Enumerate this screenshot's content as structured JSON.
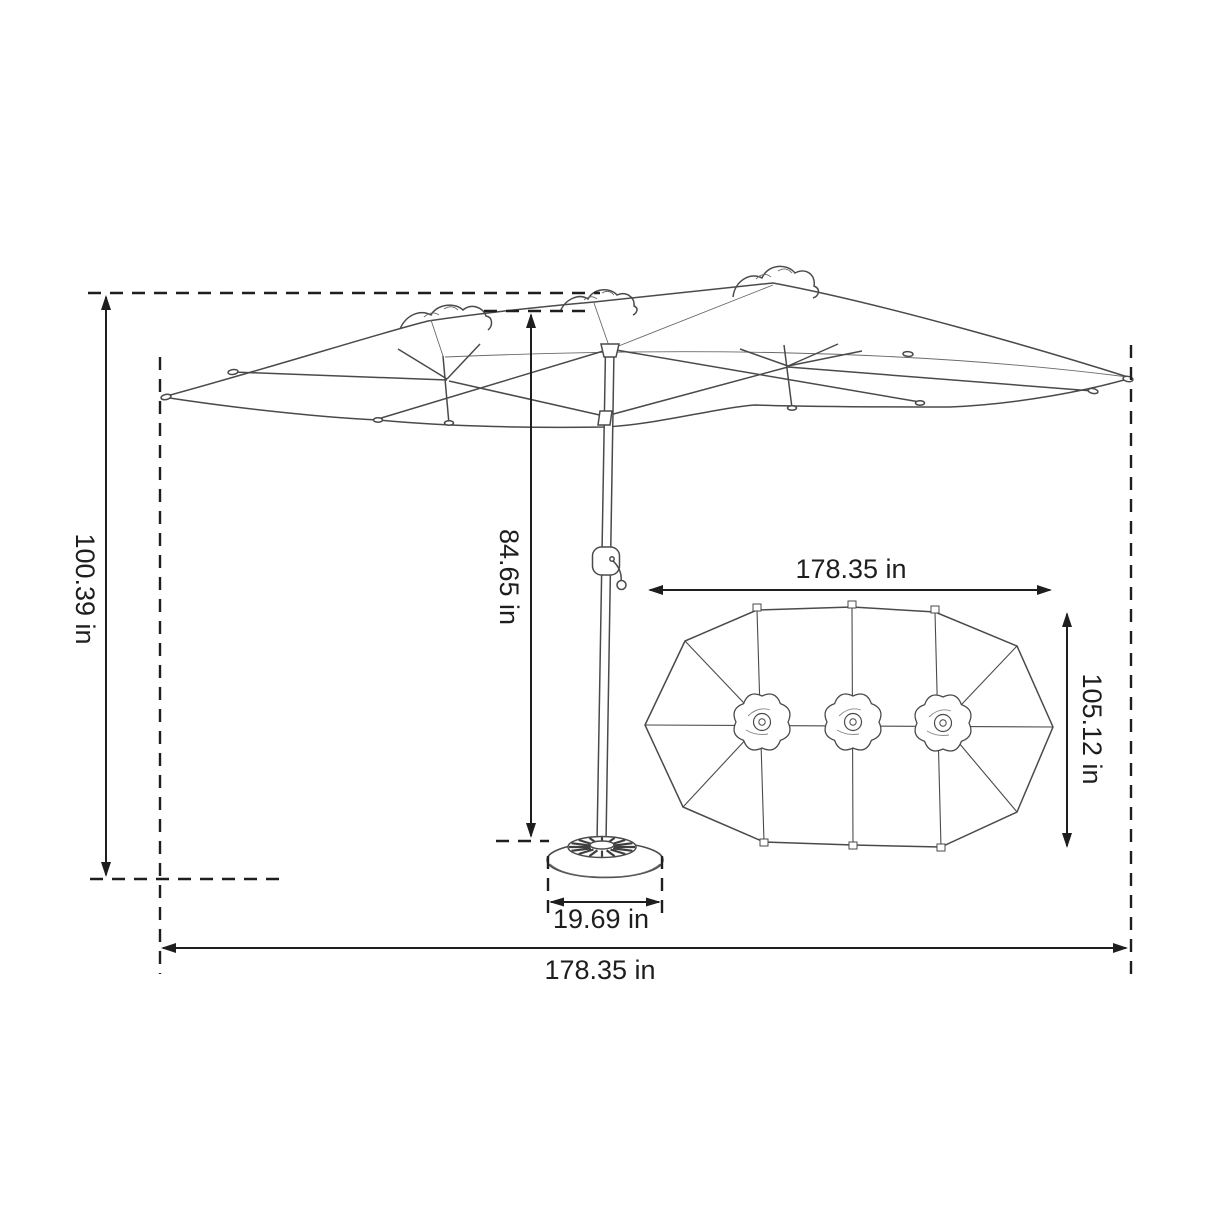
{
  "diagram": {
    "subject": "double-sided patio umbrella dimension drawing",
    "unit": "in",
    "background_color": "#ffffff",
    "dimension_line_color": "#1e1e1e",
    "sketch_line_color": "#4a4a4a",
    "dimensions": {
      "overall_height": "100.39 in",
      "pole_height": "84.65 in",
      "canopy_width_top_view": "178.35 in",
      "canopy_depth_top_view": "105.12 in",
      "base_width": "19.69 in",
      "overall_width": "178.35 in"
    }
  }
}
